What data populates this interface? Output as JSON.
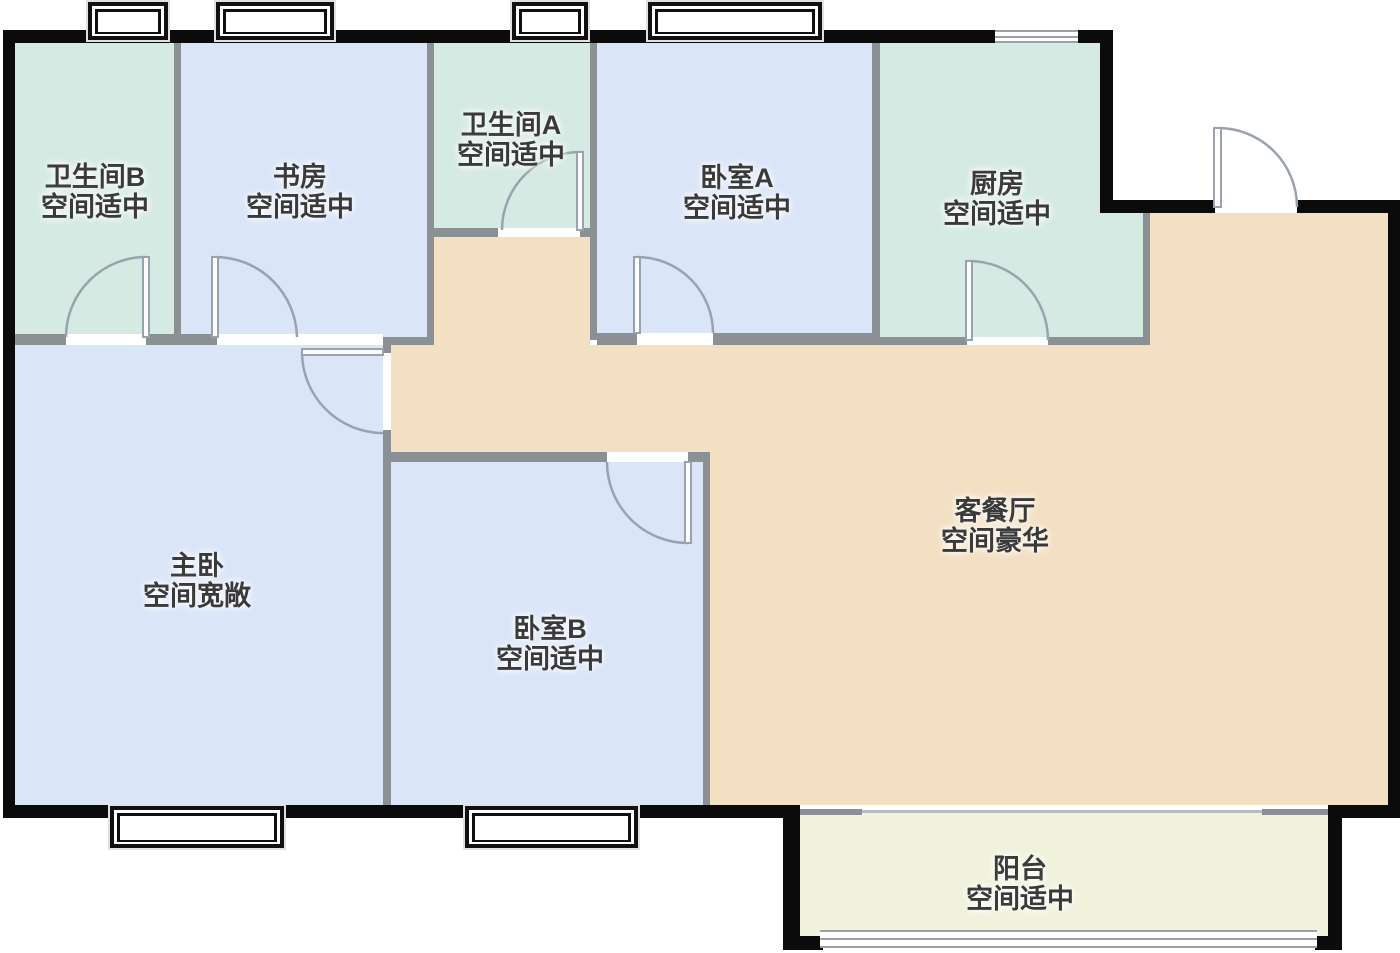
{
  "floorplan": {
    "rooms": {
      "bathroom_b": {
        "name": "卫生间B",
        "desc": "空间适中"
      },
      "study": {
        "name": "书房",
        "desc": "空间适中"
      },
      "bathroom_a": {
        "name": "卫生间A",
        "desc": "空间适中"
      },
      "bedroom_a": {
        "name": "卧室A",
        "desc": "空间适中"
      },
      "kitchen": {
        "name": "厨房",
        "desc": "空间适中"
      },
      "master_bedroom": {
        "name": "主卧",
        "desc": "空间宽敞"
      },
      "bedroom_b": {
        "name": "卧室B",
        "desc": "空间适中"
      },
      "living_dining": {
        "name": "客餐厅",
        "desc": "空间豪华"
      },
      "balcony": {
        "name": "阳台",
        "desc": "空间适中"
      }
    },
    "colors": {
      "wall": "#0b0b0b",
      "part": "#8b9095",
      "wet": "#d5eae3",
      "bed": "#dae5f8",
      "living": "#f3dfc2",
      "balcony": "#f0f2dc",
      "door": "#9aa3ac",
      "txt": "#3a3a3a",
      "wframe": "#101010"
    }
  }
}
